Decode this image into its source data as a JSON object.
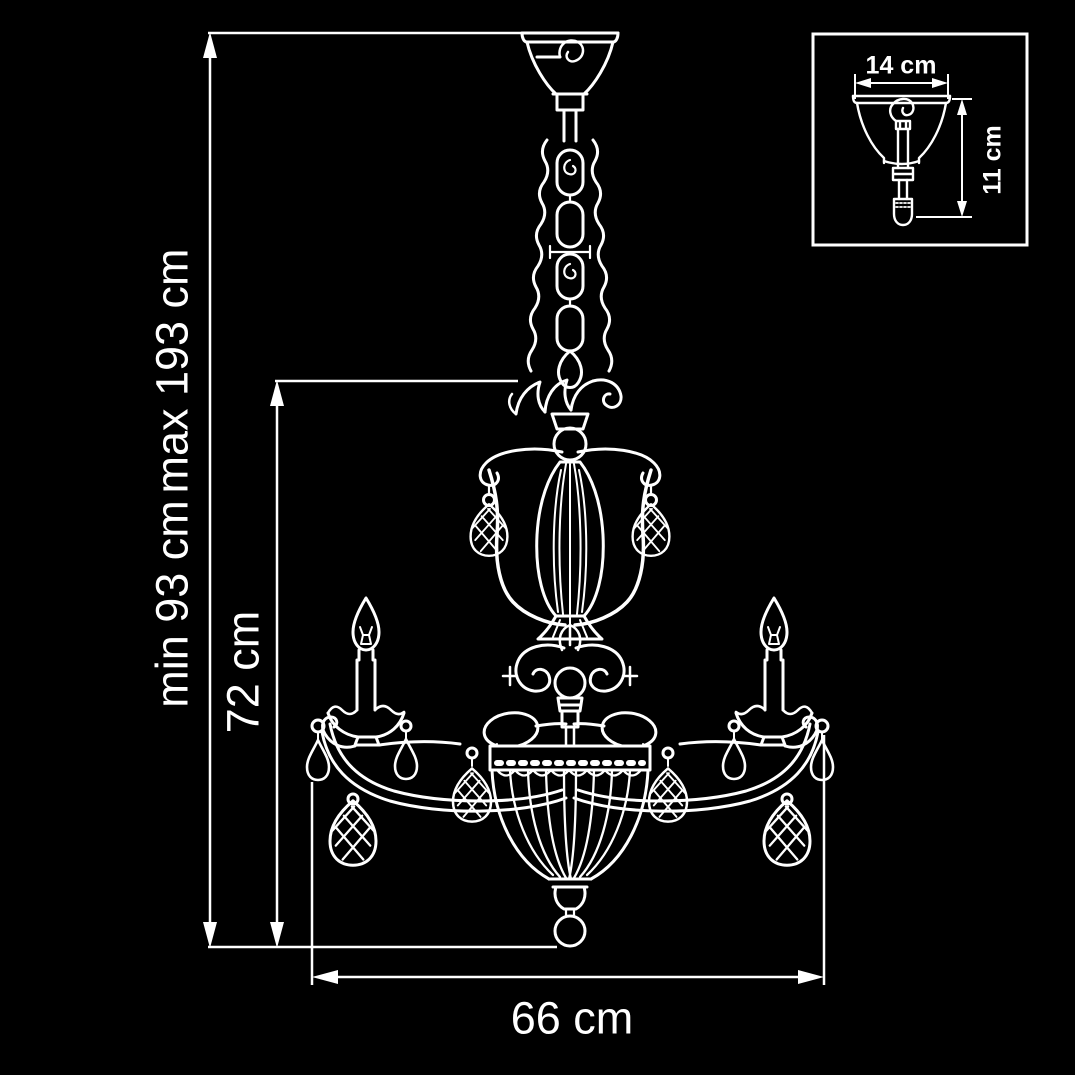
{
  "diagram": {
    "type": "technical dimension drawing",
    "subject": "crystal chandelier with two candle arms, chain suspension, ribbed basket bowl and ceiling canopy detail inset",
    "background_color": "#000000",
    "line_color": "#ffffff"
  },
  "labels": {
    "height_max": "max 193 cm",
    "height_min": "min 93 cm",
    "body_height": "72 cm",
    "width": "66 cm",
    "canopy_width": "14 cm",
    "canopy_height": "11 cm"
  }
}
